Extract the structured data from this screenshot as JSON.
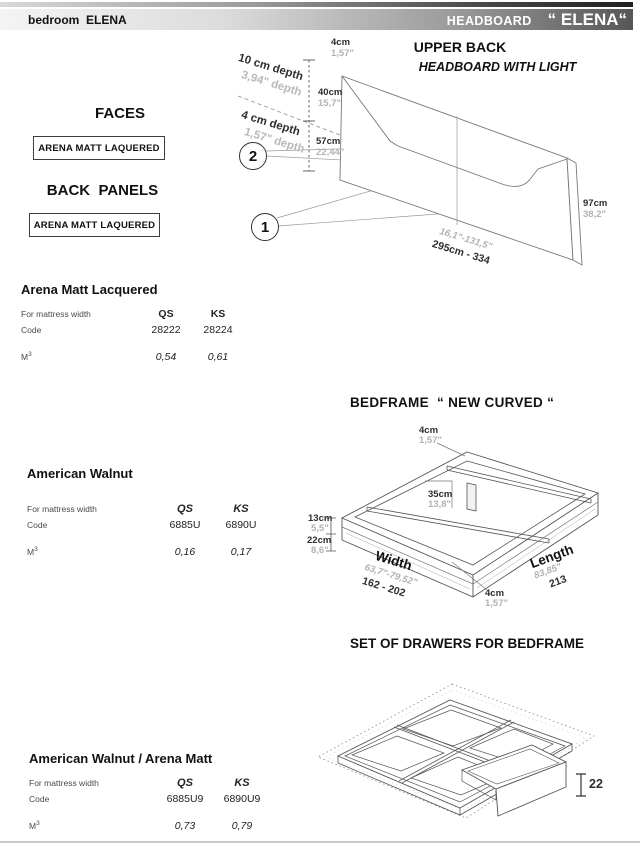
{
  "header": {
    "left": "bedroom  ELENA",
    "right_label": "HEADBOARD",
    "right_name": "“ ELENA“"
  },
  "upper_back": {
    "title": "UPPER BACK",
    "subtitle": "HEADBOARD WITH LIGHT",
    "callout_upper": "2",
    "callout_lower": "1",
    "dims": {
      "top_cm": "4cm",
      "top_in": "1,57\"",
      "depth10_cm": "10 cm depth",
      "depth10_in": "3,94\" depth",
      "depth4_cm": "4 cm depth",
      "depth4_in": "1,57\" depth",
      "h40_cm": "40cm",
      "h40_in": "15,7\"",
      "h57_cm": "57cm",
      "h57_in": "22,44\"",
      "h97_cm": "97cm",
      "h97_in": "38,2\"",
      "width_in": "16,1\"-131,5\"",
      "width_cm": "295cm - 334"
    }
  },
  "faces": {
    "heading": "FACES",
    "finish": "ARENA MATT LAQUERED"
  },
  "back_panels": {
    "heading": "BACK  PANELS",
    "finish": "ARENA MATT LAQUERED"
  },
  "tables": {
    "headboard": {
      "title": "Arena Matt Lacquered",
      "row_header": "For mattress width",
      "col1": "QS",
      "col2": "KS",
      "code_label": "Code",
      "code1": "28222",
      "code2": "28224",
      "m3_base": "M",
      "m3_exp": "3",
      "m3_1": "0,54",
      "m3_2": "0,61"
    },
    "bedframe": {
      "title": "American Walnut",
      "row_header": "For mattress width",
      "col1": "QS",
      "col2": "KS",
      "code_label": "Code",
      "code1": "6885U",
      "code2": "6890U",
      "m3_base": "M",
      "m3_exp": "3",
      "m3_1": "0,16",
      "m3_2": "0,17"
    },
    "drawers": {
      "title": "American Walnut / Arena Matt",
      "row_header": "For mattress width",
      "col1": "QS",
      "col2": "KS",
      "code_label": "Code",
      "code1": "6885U9",
      "code2": "6890U9",
      "m3_base": "M",
      "m3_exp": "3",
      "m3_1": "0,73",
      "m3_2": "0,79"
    }
  },
  "bedframe": {
    "title": "BEDFRAME  “ NEW CURVED “",
    "dims": {
      "frame_cm": "4cm",
      "frame_in": "1,57\"",
      "leg_cm": "35cm",
      "leg_in": "13,8\"",
      "h13_cm": "13cm",
      "h13_in": "5,5\"",
      "h22_cm": "22cm",
      "h22_in": "8,6\"",
      "width_label": "Width",
      "width_in": "63,7\"-79,52\"",
      "width_cm": "162 - 202",
      "length_label": "Length",
      "length_in": "83,85\"",
      "length_cm": "213",
      "frame2_cm": "4cm",
      "frame2_in": "1,57\""
    }
  },
  "drawers": {
    "title": "SET OF DRAWERS FOR BEDFRAME",
    "height": "22"
  }
}
